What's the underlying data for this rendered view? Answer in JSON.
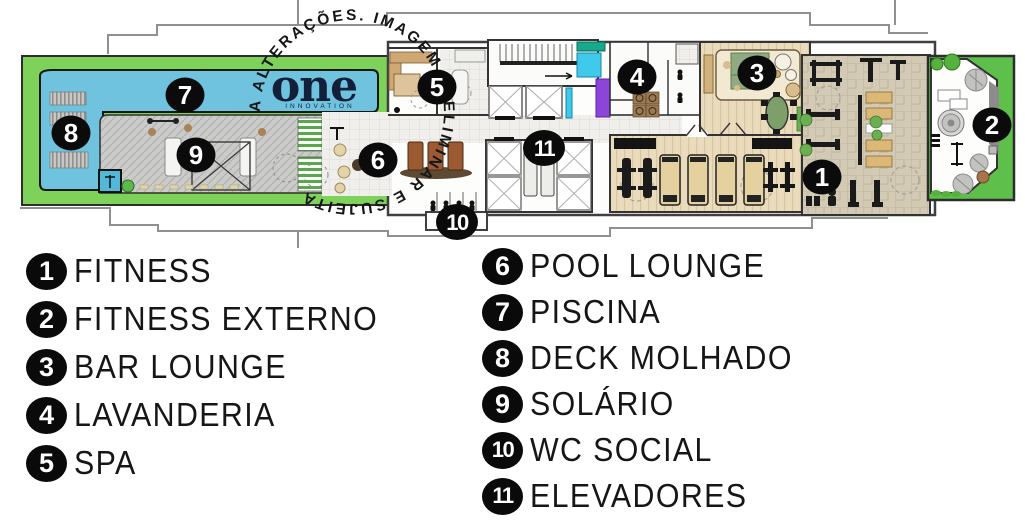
{
  "plan": {
    "watermark_text": "A ALTERAÇÕES.  IMAGEM  PRELIMINAR  E  SUJEITA ",
    "logo": {
      "text": "one",
      "subtext": "INNOVATION"
    },
    "markers": [
      {
        "number": "1",
        "room": "fitness"
      },
      {
        "number": "2",
        "room": "fitness-externo"
      },
      {
        "number": "3",
        "room": "bar-lounge"
      },
      {
        "number": "4",
        "room": "lavanderia"
      },
      {
        "number": "5",
        "room": "spa"
      },
      {
        "number": "6",
        "room": "pool-lounge"
      },
      {
        "number": "7",
        "room": "piscina"
      },
      {
        "number": "8",
        "room": "deck-molhado"
      },
      {
        "number": "9",
        "room": "solario"
      },
      {
        "number": "10",
        "room": "wc-social"
      },
      {
        "number": "11",
        "room": "elevadores"
      }
    ]
  },
  "legend": {
    "left_column": [
      {
        "number": "1",
        "label": "FITNESS"
      },
      {
        "number": "2",
        "label": "FITNESS EXTERNO"
      },
      {
        "number": "3",
        "label": "BAR LOUNGE"
      },
      {
        "number": "4",
        "label": "LAVANDERIA"
      },
      {
        "number": "5",
        "label": "SPA"
      }
    ],
    "right_column": [
      {
        "number": "6",
        "label": "POOL LOUNGE"
      },
      {
        "number": "7",
        "label": "PISCINA"
      },
      {
        "number": "8",
        "label": "DECK MOLHADO"
      },
      {
        "number": "9",
        "label": "SOLÁRIO"
      },
      {
        "number": "10",
        "label": "WC SOCIAL"
      },
      {
        "number": "11",
        "label": "ELEVADORES"
      }
    ]
  },
  "colors": {
    "lawn_green": "#7ed25a",
    "wing_green": "#5fbf4b",
    "pool_blue": "#6fc3de",
    "locker_cyan": "#3fc9ea",
    "locker_teal": "#16a98c",
    "locker_purple": "#8d44d8",
    "marker_black": "#0b0b0b",
    "logo_navy": "#13203a"
  }
}
